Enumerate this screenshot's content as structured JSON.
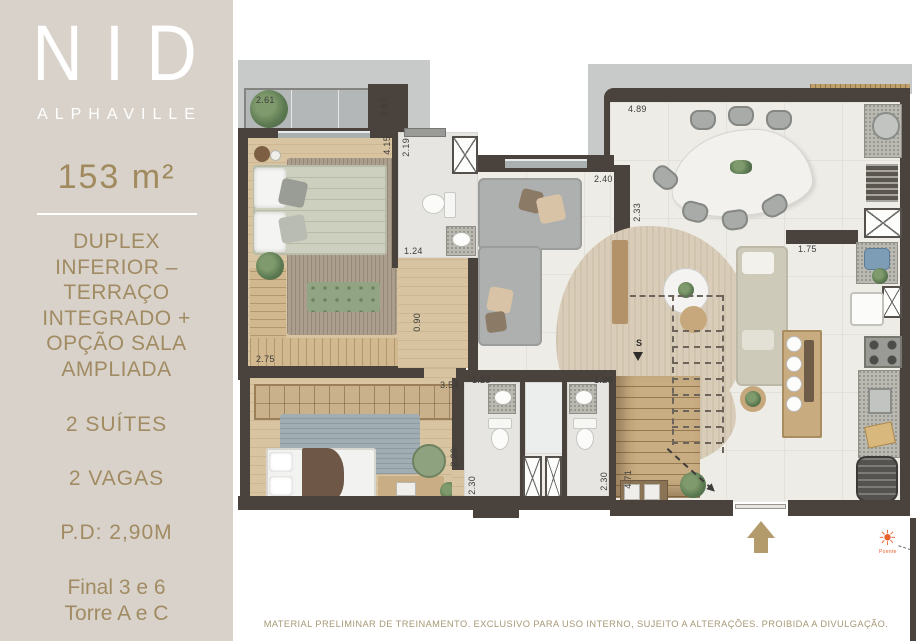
{
  "sidebar": {
    "brand": "NID",
    "brand_sub": "ALPHAVILLE",
    "area": "153 m²",
    "description": "DUPLEX INFERIOR – TERRAÇO INTEGRADO + OPÇÃO SALA AMPLIADA",
    "suites": "2 SUÍTES",
    "parking": "2 VAGAS",
    "ceiling_height": "P.D: 2,90M",
    "unit_final": "Final 3 e 6",
    "unit_tower": "Torre A e C"
  },
  "plan": {
    "stair_marker": "S",
    "compass_label": "Poente",
    "dimensions": [
      {
        "text": "2.61",
        "x": 20,
        "y": 95,
        "v": false
      },
      {
        "text": "0.60",
        "x": 143,
        "y": 98,
        "v": true
      },
      {
        "text": "4.15",
        "x": 146,
        "y": 136,
        "v": true
      },
      {
        "text": "2.19",
        "x": 165,
        "y": 138,
        "v": true
      },
      {
        "text": "1.24",
        "x": 168,
        "y": 246,
        "v": false
      },
      {
        "text": "2.40",
        "x": 358,
        "y": 174,
        "v": false
      },
      {
        "text": "2.33",
        "x": 396,
        "y": 203,
        "v": true
      },
      {
        "text": "4.89",
        "x": 392,
        "y": 104,
        "v": false
      },
      {
        "text": "1.75",
        "x": 562,
        "y": 244,
        "v": false
      },
      {
        "text": "0.90",
        "x": 176,
        "y": 313,
        "v": true
      },
      {
        "text": "2.75",
        "x": 20,
        "y": 354,
        "v": false
      },
      {
        "text": "3.54",
        "x": 204,
        "y": 380,
        "v": false
      },
      {
        "text": "1.23",
        "x": 236,
        "y": 375,
        "v": false
      },
      {
        "text": "2.26",
        "x": 213,
        "y": 448,
        "v": true
      },
      {
        "text": "2.30",
        "x": 231,
        "y": 476,
        "v": true
      },
      {
        "text": "1.20",
        "x": 358,
        "y": 375,
        "v": false
      },
      {
        "text": "2.30",
        "x": 363,
        "y": 472,
        "v": true
      },
      {
        "text": "4.71",
        "x": 387,
        "y": 470,
        "v": true
      }
    ]
  },
  "footer": {
    "disclaimer": "MATERIAL PRELIMINAR DE TREINAMENTO. EXCLUSIVO PARA USO INTERNO, SUJEITO A ALTERAÇÕES. PROIBIDA A DIVULGAÇÃO."
  },
  "colors": {
    "sidebar_bg": "#d8d2ca",
    "brand_text": "#ffffff",
    "gold_text": "#a08a5e",
    "wall": "#4a423c",
    "entry_arrow": "#b49b6b",
    "sun_orange": "#e8622d"
  }
}
